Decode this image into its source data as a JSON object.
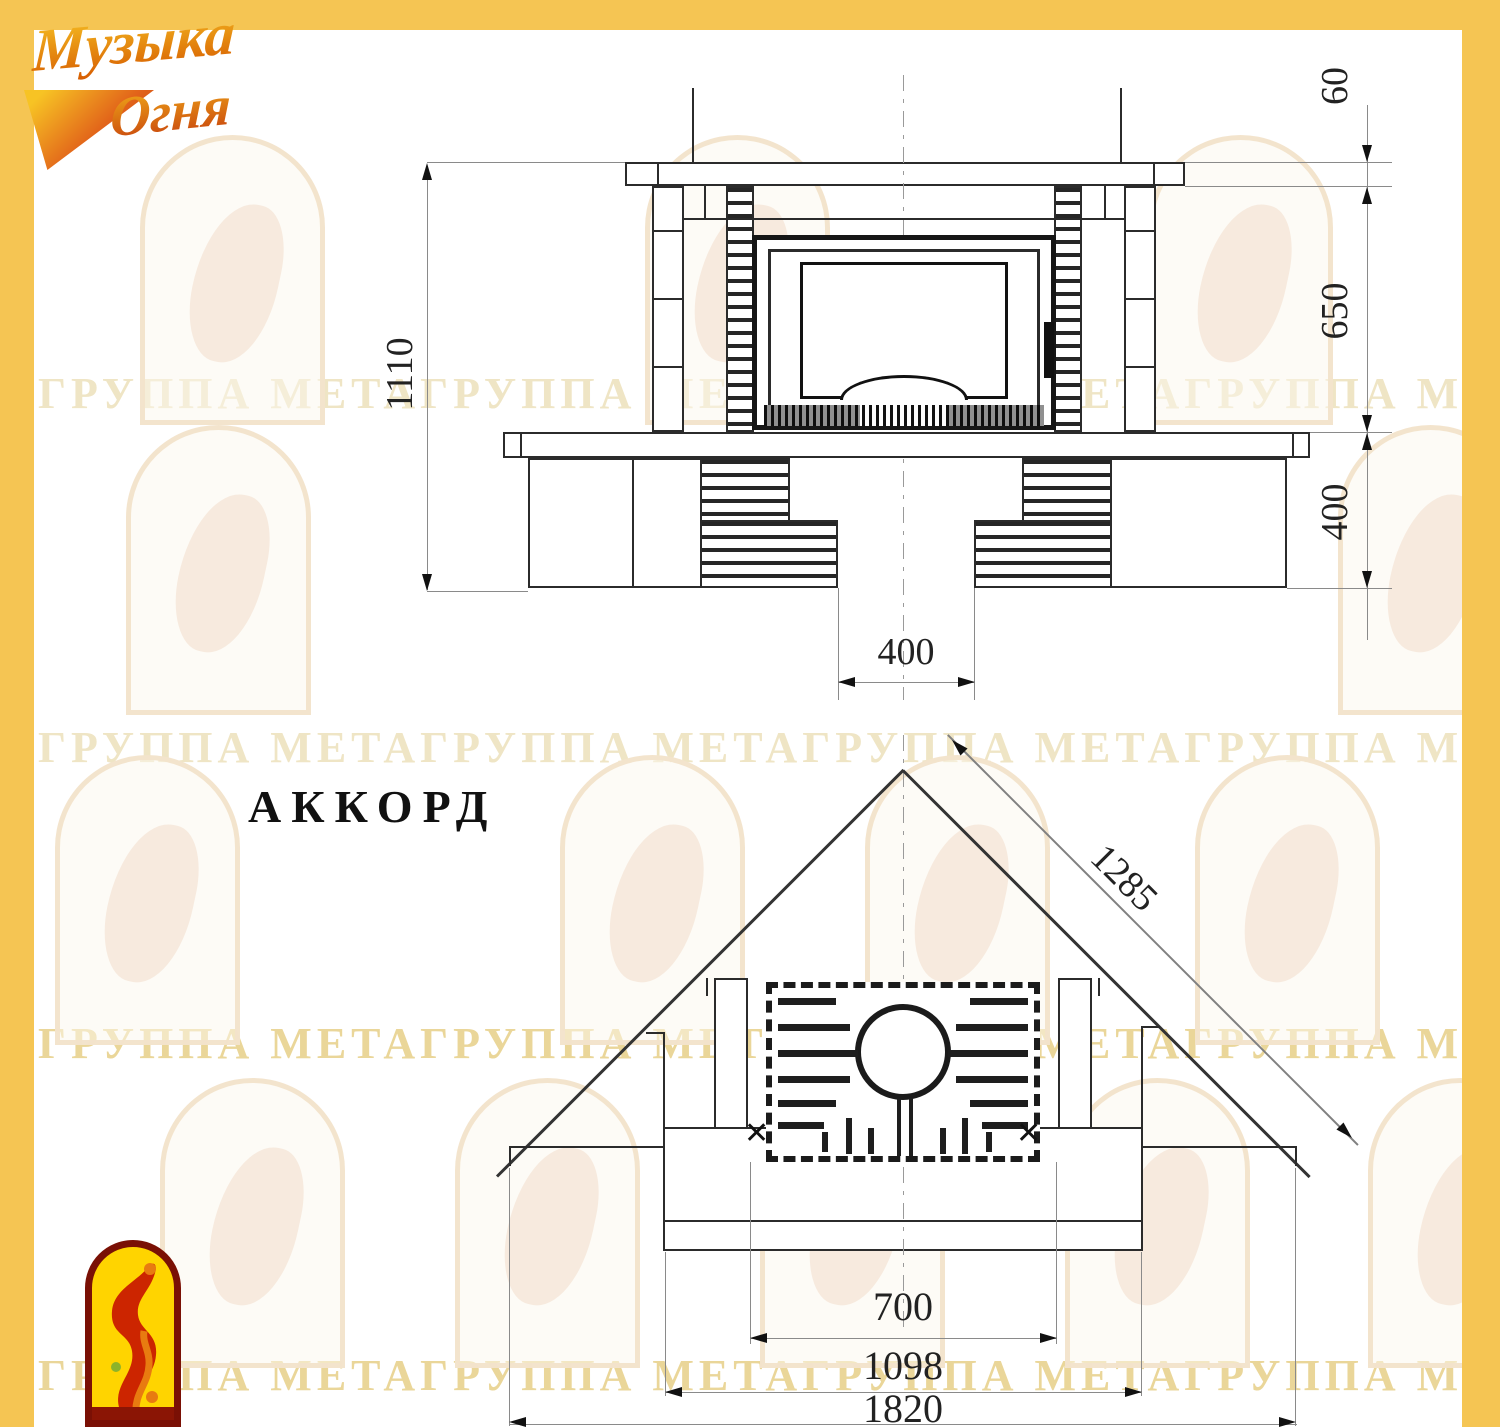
{
  "logo": {
    "line1": "Музыка",
    "line2": "Огня"
  },
  "title": "АККОРД",
  "watermark": {
    "text": "ГРУППА МЕТАГРУППА МЕТАГРУППА МЕТАГРУППА МЕТАГРУППА МЕТА"
  },
  "front_view": {
    "dims": {
      "total_height": "1110",
      "shelf_thickness": "60",
      "firebox_zone_height": "650",
      "base_zone_height": "400",
      "base_opening_width": "400"
    }
  },
  "plan_view": {
    "dims": {
      "wall_diagonal": "1285",
      "opening_width": "700",
      "body_width": "1098",
      "total_width": "1820"
    }
  },
  "icons": {
    "damper_x": "✕"
  },
  "colors": {
    "accent_yellow": "#f5c553",
    "drawing_line": "#2b2b2b",
    "watermark": "#eddfb4",
    "logo_gold": "#f7c324",
    "logo_red": "#c43b0c",
    "emblem_background": "#ffd400",
    "emblem_border": "#7a1005",
    "emblem_bird": "#cc2500"
  }
}
